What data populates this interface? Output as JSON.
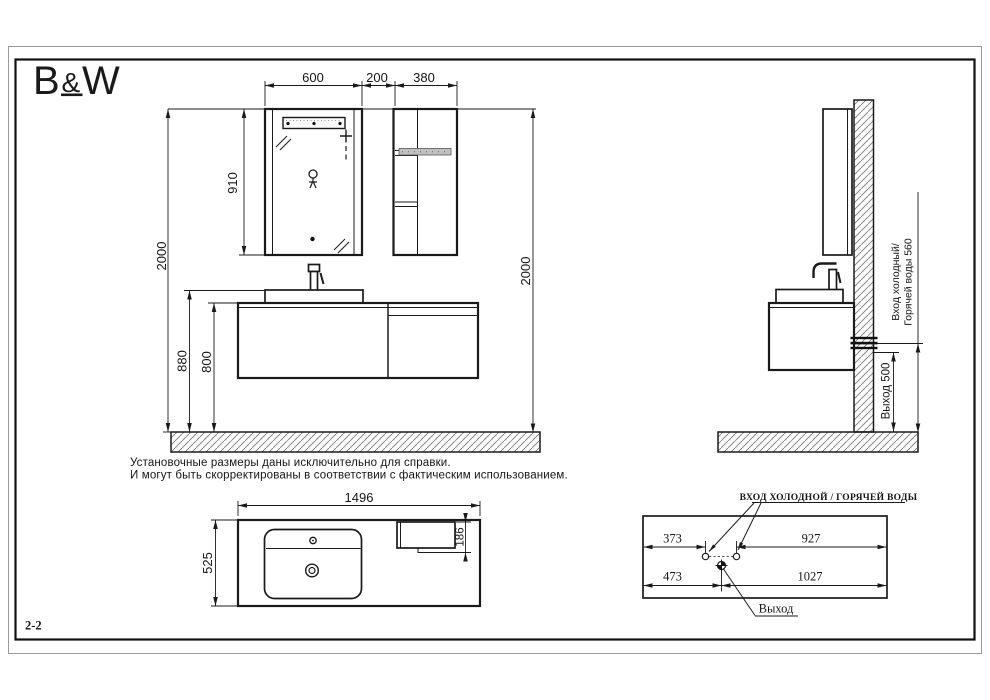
{
  "colors": {
    "line": "#1a1a1a",
    "hatch": "#777777",
    "towel_bar": "#c0c0c0"
  },
  "logo": {
    "b": "B",
    "amp": "&",
    "w": "W"
  },
  "section_label": "2-2",
  "front_view": {
    "top_dims": {
      "mirror_width": "600",
      "gap": "200",
      "shelf_width": "380"
    },
    "mirror_height": "910",
    "total_height_left": "2000",
    "total_height_right": "2000",
    "countertop_height": "880",
    "cabinet_top_height": "800"
  },
  "side_view": {
    "inlet_label_line1": "Вход холодный/",
    "inlet_label_line2": "Горячей воды 560",
    "outlet_label": "Выход 500"
  },
  "notes": {
    "line1": "Установочные размеры даны исключительно для справки.",
    "line2": "И могут быть скорректированы в соответствии с фактическим использованием."
  },
  "countertop_plan": {
    "width": "1496",
    "depth": "525",
    "shelf_depth": "186"
  },
  "wall_plan": {
    "inlets_label": "ВХОД ХОЛОДНОЙ / ГОРЯЧЕЙ ВОДЫ",
    "inlet_offset_left": "373",
    "inlet_offset_right": "927",
    "outlet_offset_left": "473",
    "outlet_offset_right": "1027",
    "outlet_label": "Выход"
  }
}
